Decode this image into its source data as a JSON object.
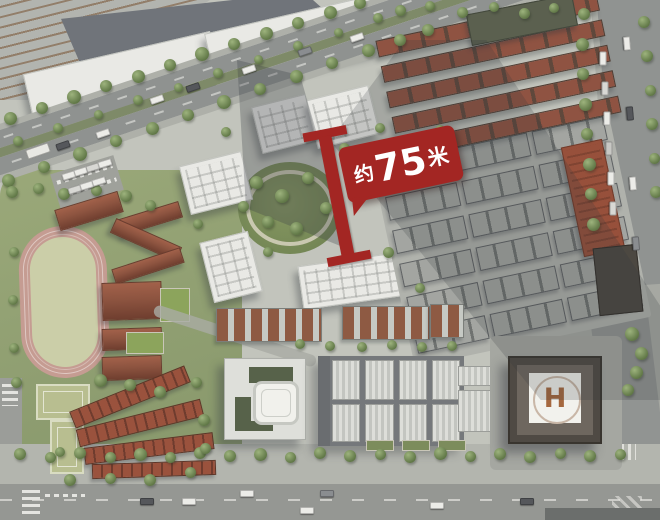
{
  "annotation": {
    "prefix": "约",
    "value": "75",
    "unit": "米",
    "full_label": "约75米",
    "box_color": "#A32623",
    "text_color": "#FFFFFF"
  },
  "helipad": {
    "label": "H",
    "letter_color": "#A5683F"
  },
  "palette": {
    "accent_red": "#A32623",
    "ground": "#C2C4BC",
    "road": "#949692",
    "green_space": "#93A273",
    "track_lane": "#C59C92",
    "track_infield": "#CBCEA8",
    "red_roof": "#8F5342",
    "gray_roof": "#A3A5A1",
    "white_roof": "#E9E9E5",
    "dark_roof": "#70747A"
  }
}
